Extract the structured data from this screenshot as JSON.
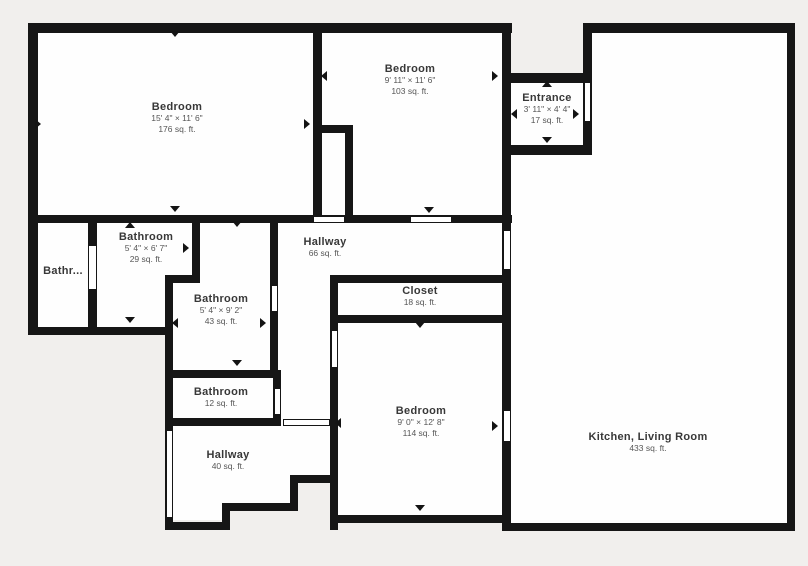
{
  "colors": {
    "background": "#f1efed",
    "wall": "#161616",
    "floor": "#fefefe",
    "room_name_text": "#383838",
    "room_detail_text": "#565656"
  },
  "rooms": [
    {
      "id": "bedroom-master",
      "name": "Bedroom",
      "dims": "15' 4\" × 11' 6\"",
      "area": "176 sq. ft."
    },
    {
      "id": "bedroom-2",
      "name": "Bedroom",
      "dims": "9' 11\" × 11' 6\"",
      "area": "103 sq. ft."
    },
    {
      "id": "entrance",
      "name": "Entrance",
      "dims": "3' 11\" × 4' 4\"",
      "area": "17 sq. ft."
    },
    {
      "id": "bathroom-left",
      "name": "Bathr..."
    },
    {
      "id": "bathroom-29",
      "name": "Bathroom",
      "dims": "5' 4\" × 6' 7\"",
      "area": "29 sq. ft."
    },
    {
      "id": "hallway-66",
      "name": "Hallway",
      "area": "66 sq. ft."
    },
    {
      "id": "closet",
      "name": "Closet",
      "area": "18 sq. ft."
    },
    {
      "id": "bathroom-43",
      "name": "Bathroom",
      "dims": "5' 4\" × 9' 2\"",
      "area": "43 sq. ft."
    },
    {
      "id": "bathroom-12",
      "name": "Bathroom",
      "area": "12 sq. ft."
    },
    {
      "id": "hallway-40",
      "name": "Hallway",
      "area": "40 sq. ft."
    },
    {
      "id": "bedroom-3",
      "name": "Bedroom",
      "dims": "9' 0\" × 12' 8\"",
      "area": "114 sq. ft."
    },
    {
      "id": "kitchen-living",
      "name": "Kitchen, Living Room",
      "area": "433 sq. ft."
    }
  ],
  "plan": {
    "floors": [
      [
        36,
        31,
        277,
        184
      ],
      [
        322,
        31,
        180,
        94
      ],
      [
        353,
        125,
        149,
        90
      ],
      [
        322,
        133,
        23,
        82
      ],
      [
        511,
        83,
        72,
        62
      ],
      [
        592,
        33,
        195,
        490
      ],
      [
        511,
        155,
        81,
        368
      ],
      [
        36,
        223,
        52,
        104
      ],
      [
        97,
        223,
        95,
        52
      ],
      [
        97,
        223,
        68,
        104
      ],
      [
        200,
        223,
        70,
        147
      ],
      [
        173,
        283,
        27,
        87
      ],
      [
        278,
        223,
        224,
        52
      ],
      [
        278,
        223,
        52,
        203
      ],
      [
        338,
        283,
        164,
        32
      ],
      [
        338,
        323,
        164,
        192
      ],
      [
        173,
        378,
        100,
        40
      ],
      [
        173,
        426,
        157,
        49
      ],
      [
        173,
        426,
        117,
        77
      ],
      [
        173,
        426,
        49,
        94
      ]
    ],
    "walls": [
      [
        28,
        23,
        484,
        10
      ],
      [
        583,
        23,
        212,
        10
      ],
      [
        28,
        23,
        10,
        312
      ],
      [
        28,
        327,
        145,
        8
      ],
      [
        88,
        215,
        9,
        120
      ],
      [
        28,
        215,
        484,
        8
      ],
      [
        313,
        31,
        9,
        192
      ],
      [
        313,
        125,
        40,
        8
      ],
      [
        345,
        125,
        8,
        98
      ],
      [
        192,
        223,
        8,
        60
      ],
      [
        165,
        275,
        35,
        8
      ],
      [
        165,
        283,
        8,
        247
      ],
      [
        270,
        215,
        8,
        163
      ],
      [
        165,
        370,
        116,
        8
      ],
      [
        165,
        418,
        116,
        8
      ],
      [
        273,
        370,
        8,
        56
      ],
      [
        330,
        275,
        181,
        8
      ],
      [
        330,
        315,
        181,
        8
      ],
      [
        330,
        283,
        8,
        247
      ],
      [
        330,
        515,
        181,
        8
      ],
      [
        502,
        23,
        9,
        500
      ],
      [
        502,
        73,
        90,
        10
      ],
      [
        502,
        145,
        90,
        10
      ],
      [
        583,
        23,
        9,
        132
      ],
      [
        787,
        23,
        8,
        508
      ],
      [
        502,
        523,
        293,
        8
      ],
      [
        165,
        522,
        65,
        8
      ],
      [
        222,
        503,
        8,
        27
      ],
      [
        222,
        503,
        76,
        8
      ],
      [
        290,
        475,
        8,
        36
      ],
      [
        290,
        475,
        47,
        8
      ]
    ],
    "openings": [
      [
        88,
        245,
        9,
        45
      ],
      [
        313,
        216,
        32,
        7
      ],
      [
        410,
        216,
        42,
        7
      ],
      [
        584,
        82,
        7,
        40
      ],
      [
        503,
        230,
        8,
        40
      ],
      [
        271,
        285,
        7,
        27
      ],
      [
        331,
        330,
        7,
        38
      ],
      [
        274,
        388,
        7,
        27
      ],
      [
        166,
        430,
        7,
        88
      ],
      [
        503,
        410,
        8,
        32
      ],
      [
        283,
        419,
        47,
        7
      ]
    ],
    "arrows": [
      [
        175,
        36,
        "down"
      ],
      [
        40,
        124,
        "right"
      ],
      [
        309,
        124,
        "right"
      ],
      [
        175,
        211,
        "down"
      ],
      [
        326,
        76,
        "left"
      ],
      [
        497,
        76,
        "right"
      ],
      [
        429,
        212,
        "down"
      ],
      [
        547,
        86,
        "up"
      ],
      [
        516,
        114,
        "left"
      ],
      [
        578,
        114,
        "right"
      ],
      [
        547,
        142,
        "down"
      ],
      [
        130,
        227,
        "up"
      ],
      [
        188,
        248,
        "right"
      ],
      [
        130,
        322,
        "down"
      ],
      [
        237,
        226,
        "down"
      ],
      [
        177,
        323,
        "left"
      ],
      [
        265,
        323,
        "right"
      ],
      [
        237,
        365,
        "down"
      ],
      [
        340,
        423,
        "left"
      ],
      [
        420,
        327,
        "down"
      ],
      [
        497,
        426,
        "right"
      ],
      [
        420,
        510,
        "down"
      ]
    ]
  }
}
